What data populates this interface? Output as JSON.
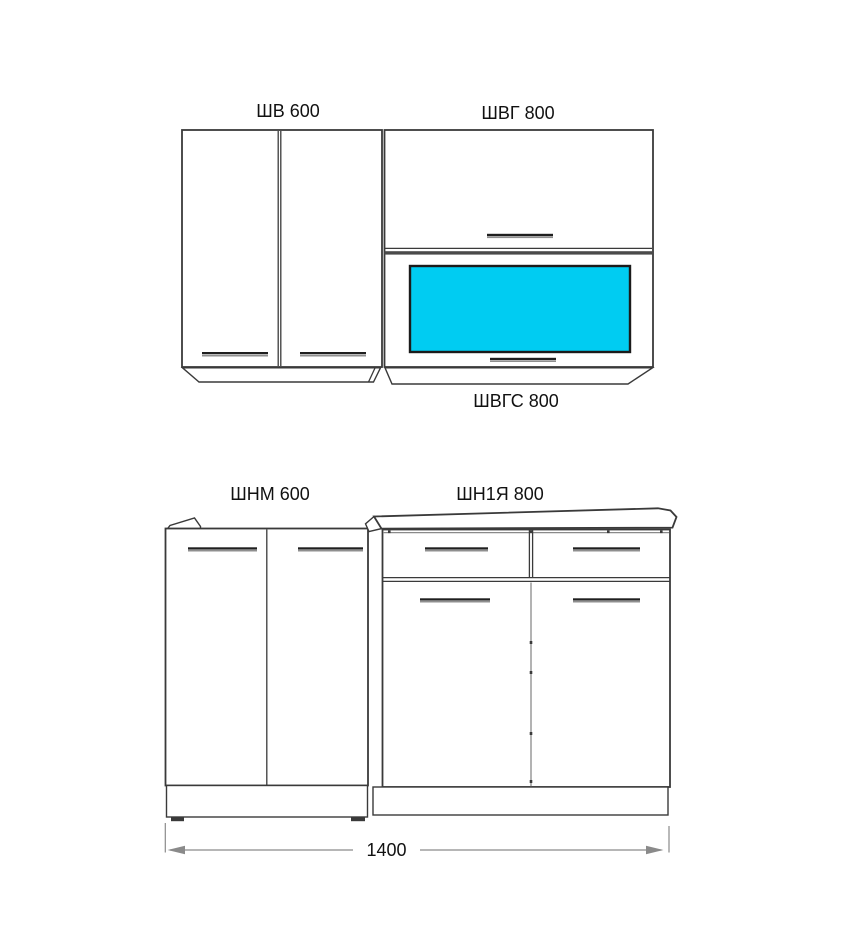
{
  "diagram": {
    "wall_cabinets": [
      {
        "code": "ШВ 600"
      },
      {
        "code": "ШВГ 800"
      },
      {
        "code": "ШВГС 800"
      }
    ],
    "base_cabinets": [
      {
        "code": "ШНМ 600"
      },
      {
        "code": "ШН1Я 800"
      }
    ],
    "dimension_total": "1400"
  },
  "colors": {
    "line_dark": "#3a3a3a",
    "line_gray": "#8a8a8a",
    "band": "#4a4a4a",
    "handle_dark": "#1f1f1f",
    "handle_light": "#8f8f8f",
    "glass_cyan": "#00ccf2",
    "glass_border": "#1b1b1b",
    "text_color": "#111111",
    "background": "#ffffff"
  }
}
